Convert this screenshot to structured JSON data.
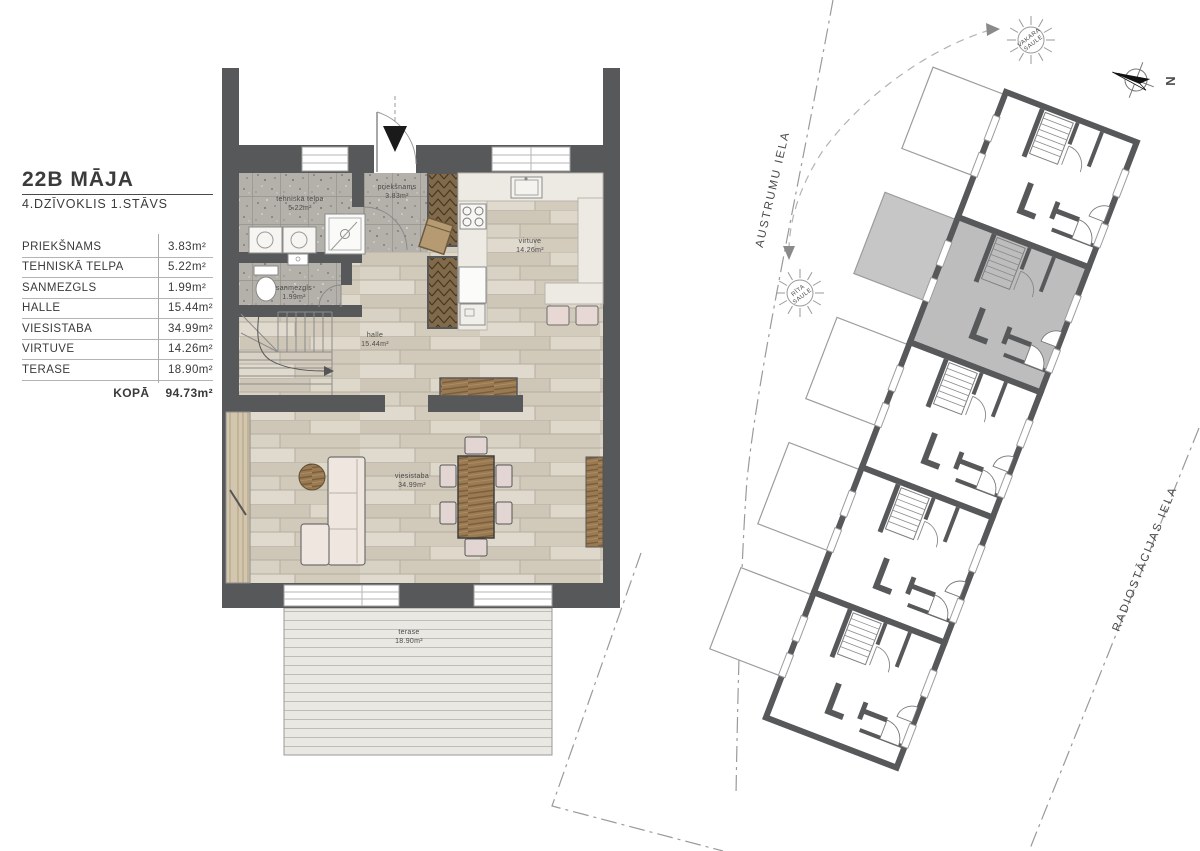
{
  "title_block": {
    "title": "22B MĀJA",
    "subtitle": "4.DZĪVOKLIS 1.STĀVS",
    "rows": [
      {
        "label": "PRIEKŠNAMS",
        "value": "3.83m²"
      },
      {
        "label": "TEHNISKĀ TELPA",
        "value": "5.22m²"
      },
      {
        "label": "SANMEZGLS",
        "value": "1.99m²"
      },
      {
        "label": "HALLE",
        "value": "15.44m²"
      },
      {
        "label": "VIESISTABA",
        "value": "34.99m²"
      },
      {
        "label": "VIRTUVE",
        "value": "14.26m²"
      },
      {
        "label": "TERASE",
        "value": "18.90m²"
      }
    ],
    "total": {
      "label": "KOPĀ",
      "value": "94.73m²"
    }
  },
  "floor_plan": {
    "rooms": {
      "tehniska_telpa": {
        "label": "tehniskā telpa",
        "area": "5.22m²"
      },
      "prieksnams": {
        "label": "priekšnams",
        "area": "3.83m²"
      },
      "sanmezgls": {
        "label": "sanmezgls",
        "area": "1.99m²"
      },
      "halle": {
        "label": "halle",
        "area": "15.44m²"
      },
      "virtuve": {
        "label": "virtuve",
        "area": "14.26m²"
      },
      "viesistaba": {
        "label": "viesistaba",
        "area": "34.99m²"
      },
      "terase": {
        "label": "terase",
        "area": "18.90m²"
      }
    }
  },
  "site_plan": {
    "streets": {
      "austrumu": "AUSTRUMU IELA",
      "radiostacijas": "RADIOSTĀCIJAS IELA"
    },
    "sun_evening": {
      "lines": [
        "VAKARA",
        "SAULE"
      ]
    },
    "sun_morning": {
      "lines": [
        "RĪTA",
        "SAULE"
      ]
    },
    "north_label": "N"
  },
  "colors": {
    "wall": "#57585a",
    "highlight_unit": "#bdbdbd",
    "boundary": "#9a9a9a"
  }
}
